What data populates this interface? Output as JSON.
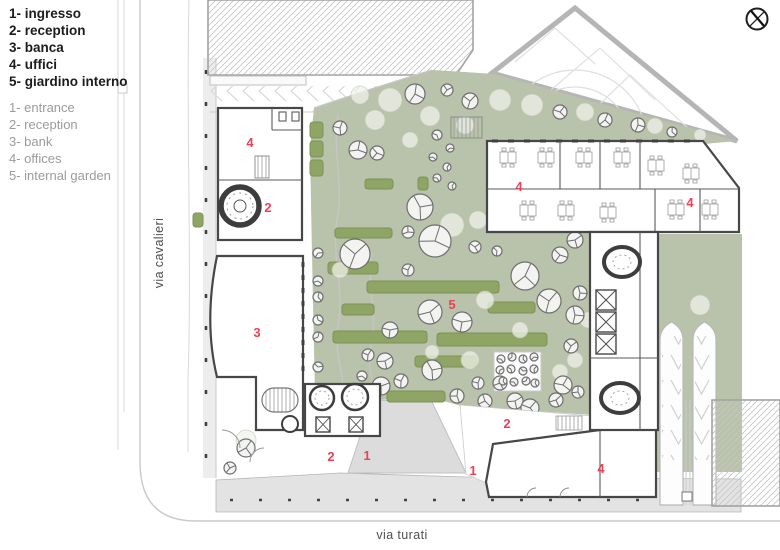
{
  "legend": {
    "italian": [
      "1- ingresso",
      "2- reception",
      "3- banca",
      "4- uffici",
      "5- giardino interno"
    ],
    "english": [
      "1- entrance",
      "2- reception",
      "3- bank",
      "4- offices",
      "5- internal garden"
    ]
  },
  "streets": {
    "left": "via cavalieri",
    "bottom": "via turati"
  },
  "north_icon": "compass-icon",
  "colors": {
    "garden": "#b9c2aa",
    "hedge": "#8fa566",
    "hedge-stroke": "#7c9154",
    "red": "#ea4256",
    "wall": "#474747",
    "plaza": "#e3e3e3",
    "road": "#c9c9c9",
    "gray-text": "#9b9b9b",
    "dark-text": "#1c1c1c",
    "street-text": "#4f4f4f"
  },
  "plan": {
    "area_numbers": [
      {
        "label": "4",
        "x": 250,
        "y": 147
      },
      {
        "label": "2",
        "x": 268,
        "y": 212
      },
      {
        "label": "3",
        "x": 257,
        "y": 337
      },
      {
        "label": "5",
        "x": 452,
        "y": 309
      },
      {
        "label": "4",
        "x": 519,
        "y": 191
      },
      {
        "label": "4",
        "x": 690,
        "y": 207
      },
      {
        "label": "2",
        "x": 331,
        "y": 461
      },
      {
        "label": "1",
        "x": 367,
        "y": 460
      },
      {
        "label": "1",
        "x": 473,
        "y": 475
      },
      {
        "label": "2",
        "x": 507,
        "y": 428
      },
      {
        "label": "4",
        "x": 601,
        "y": 473
      }
    ],
    "hedges": [
      [
        310,
        122,
        13,
        16
      ],
      [
        310,
        141,
        13,
        16
      ],
      [
        310,
        160,
        13,
        16
      ],
      [
        365,
        179,
        28,
        10
      ],
      [
        335,
        228,
        57,
        10
      ],
      [
        418,
        177,
        10,
        13
      ],
      [
        328,
        262,
        50,
        12
      ],
      [
        367,
        281,
        132,
        12
      ],
      [
        342,
        304,
        32,
        11
      ],
      [
        488,
        302,
        47,
        11
      ],
      [
        333,
        331,
        94,
        12
      ],
      [
        437,
        333,
        110,
        13
      ],
      [
        415,
        356,
        62,
        11
      ],
      [
        387,
        391,
        58,
        11
      ],
      [
        193,
        213,
        10,
        14
      ]
    ],
    "canopies": [
      [
        390,
        100,
        12
      ],
      [
        430,
        116,
        10
      ],
      [
        465,
        125,
        9
      ],
      [
        500,
        100,
        11
      ],
      [
        532,
        105,
        11
      ],
      [
        585,
        112,
        9
      ],
      [
        655,
        126,
        8
      ],
      [
        700,
        135,
        6
      ],
      [
        452,
        225,
        12
      ],
      [
        478,
        220,
        9
      ],
      [
        340,
        270,
        8
      ],
      [
        485,
        300,
        9
      ],
      [
        520,
        330,
        8
      ],
      [
        588,
        320,
        8
      ],
      [
        470,
        360,
        9
      ],
      [
        432,
        352,
        7
      ],
      [
        560,
        372,
        8
      ],
      [
        575,
        360,
        8
      ],
      [
        700,
        305,
        10
      ],
      [
        246,
        440,
        10
      ],
      [
        375,
        120,
        10
      ],
      [
        360,
        95,
        9
      ],
      [
        410,
        140,
        8
      ]
    ],
    "trees": [
      [
        340,
        128,
        7
      ],
      [
        358,
        150,
        9
      ],
      [
        377,
        153,
        7
      ],
      [
        415,
        94,
        10
      ],
      [
        447,
        90,
        6
      ],
      [
        470,
        101,
        8
      ],
      [
        560,
        112,
        7
      ],
      [
        605,
        120,
        7
      ],
      [
        638,
        125,
        7
      ],
      [
        672,
        132,
        5
      ],
      [
        420,
        207,
        13
      ],
      [
        408,
        232,
        6
      ],
      [
        355,
        254,
        15
      ],
      [
        435,
        241,
        16
      ],
      [
        475,
        247,
        6
      ],
      [
        497,
        251,
        5
      ],
      [
        525,
        276,
        14
      ],
      [
        549,
        301,
        12
      ],
      [
        580,
        293,
        7
      ],
      [
        560,
        255,
        8
      ],
      [
        575,
        240,
        8
      ],
      [
        575,
        315,
        9
      ],
      [
        430,
        312,
        12
      ],
      [
        462,
        322,
        10
      ],
      [
        390,
        330,
        8
      ],
      [
        408,
        270,
        6
      ],
      [
        318,
        253,
        5
      ],
      [
        318,
        281,
        5
      ],
      [
        318,
        297,
        5
      ],
      [
        318,
        320,
        5
      ],
      [
        318,
        337,
        5
      ],
      [
        318,
        367,
        5
      ],
      [
        368,
        355,
        6
      ],
      [
        385,
        361,
        8
      ],
      [
        362,
        376,
        5
      ],
      [
        381,
        386,
        9
      ],
      [
        401,
        381,
        7
      ],
      [
        352,
        392,
        5
      ],
      [
        432,
        370,
        10
      ],
      [
        457,
        396,
        7
      ],
      [
        478,
        383,
        6
      ],
      [
        485,
        401,
        7
      ],
      [
        500,
        383,
        7
      ],
      [
        515,
        401,
        8
      ],
      [
        530,
        408,
        9
      ],
      [
        556,
        400,
        7
      ],
      [
        571,
        346,
        7
      ],
      [
        437,
        135,
        5
      ],
      [
        450,
        148,
        4
      ],
      [
        433,
        157,
        4
      ],
      [
        447,
        167,
        4
      ],
      [
        437,
        178,
        4
      ],
      [
        452,
        186,
        4
      ],
      [
        501,
        359,
        4
      ],
      [
        512,
        357,
        4
      ],
      [
        523,
        359,
        4
      ],
      [
        534,
        357,
        4
      ],
      [
        500,
        370,
        4
      ],
      [
        511,
        369,
        4
      ],
      [
        523,
        371,
        4
      ],
      [
        534,
        369,
        4
      ],
      [
        503,
        381,
        4
      ],
      [
        514,
        382,
        4
      ],
      [
        526,
        381,
        4
      ],
      [
        535,
        383,
        4
      ],
      [
        563,
        385,
        9
      ],
      [
        578,
        392,
        6
      ],
      [
        246,
        448,
        9
      ],
      [
        230,
        468,
        6
      ]
    ],
    "desks": [
      [
        500,
        152
      ],
      [
        538,
        152
      ],
      [
        576,
        152
      ],
      [
        614,
        152
      ],
      [
        648,
        160
      ],
      [
        683,
        168
      ],
      [
        520,
        205
      ],
      [
        558,
        205
      ],
      [
        600,
        207
      ],
      [
        668,
        204
      ],
      [
        702,
        204
      ]
    ]
  }
}
